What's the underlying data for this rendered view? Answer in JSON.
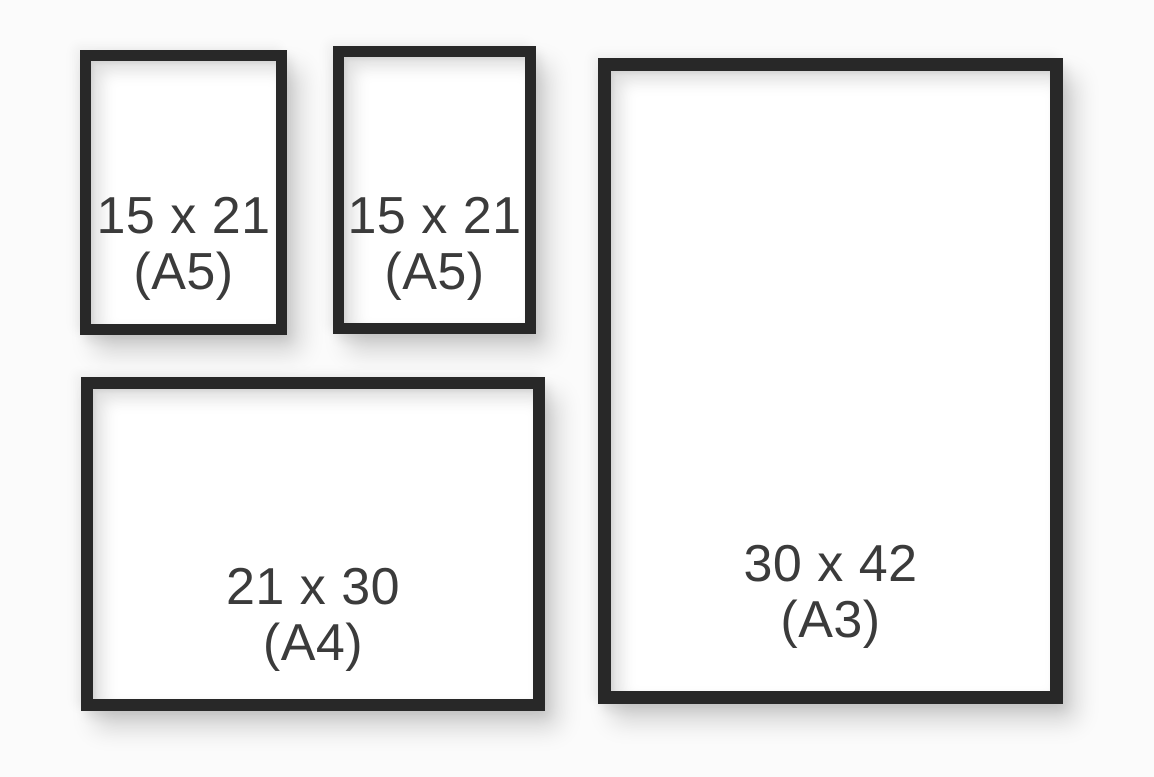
{
  "image": {
    "description": "Size comparison of four black picture frames on a light wall",
    "background_color": "#fbfbfb",
    "frame_color": "#282828",
    "paper_color": "#ffffff",
    "label_color": "#3b3b3b"
  },
  "frames": [
    {
      "name": "a5-left",
      "orientation": "portrait",
      "size_label": "15 x 21",
      "format_label": "(A5)"
    },
    {
      "name": "a5-middle",
      "orientation": "portrait",
      "size_label": "15 x 21",
      "format_label": "(A5)"
    },
    {
      "name": "a3-right",
      "orientation": "portrait",
      "size_label": "30 x 42",
      "format_label": "(A3)"
    },
    {
      "name": "a4-bottom",
      "orientation": "landscape",
      "size_label": "21 x 30",
      "format_label": "(A4)"
    }
  ]
}
